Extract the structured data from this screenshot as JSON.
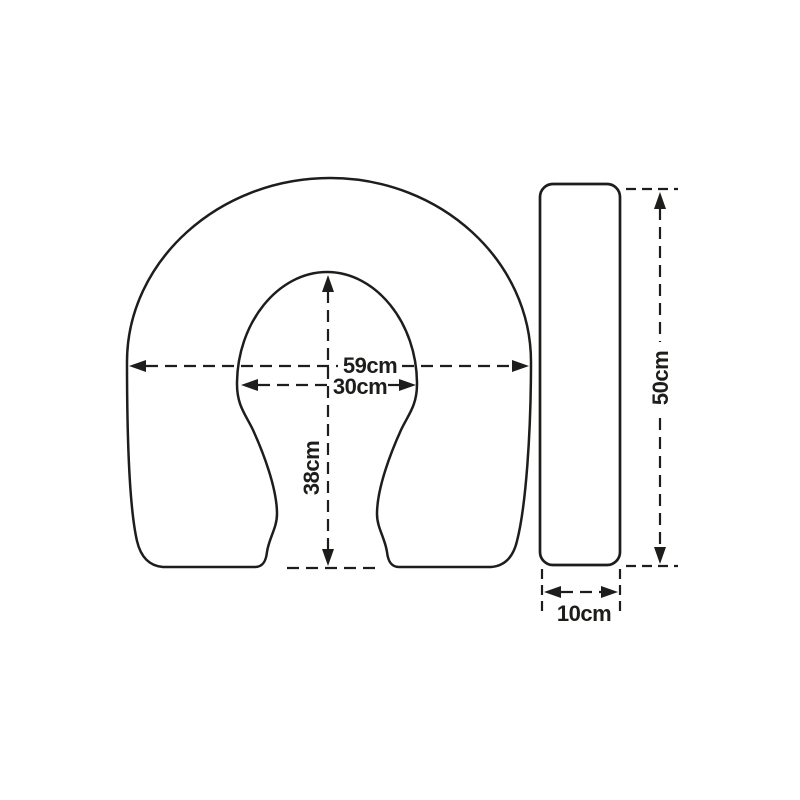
{
  "diagram": {
    "front_view": {
      "outer_width_label": "59cm",
      "inner_width_label": "30cm",
      "inner_depth_label": "38cm"
    },
    "side_view": {
      "length_label": "50cm",
      "thickness_label": "10cm"
    },
    "colors": {
      "line": "#1d1d1b",
      "background": "#ffffff"
    }
  }
}
